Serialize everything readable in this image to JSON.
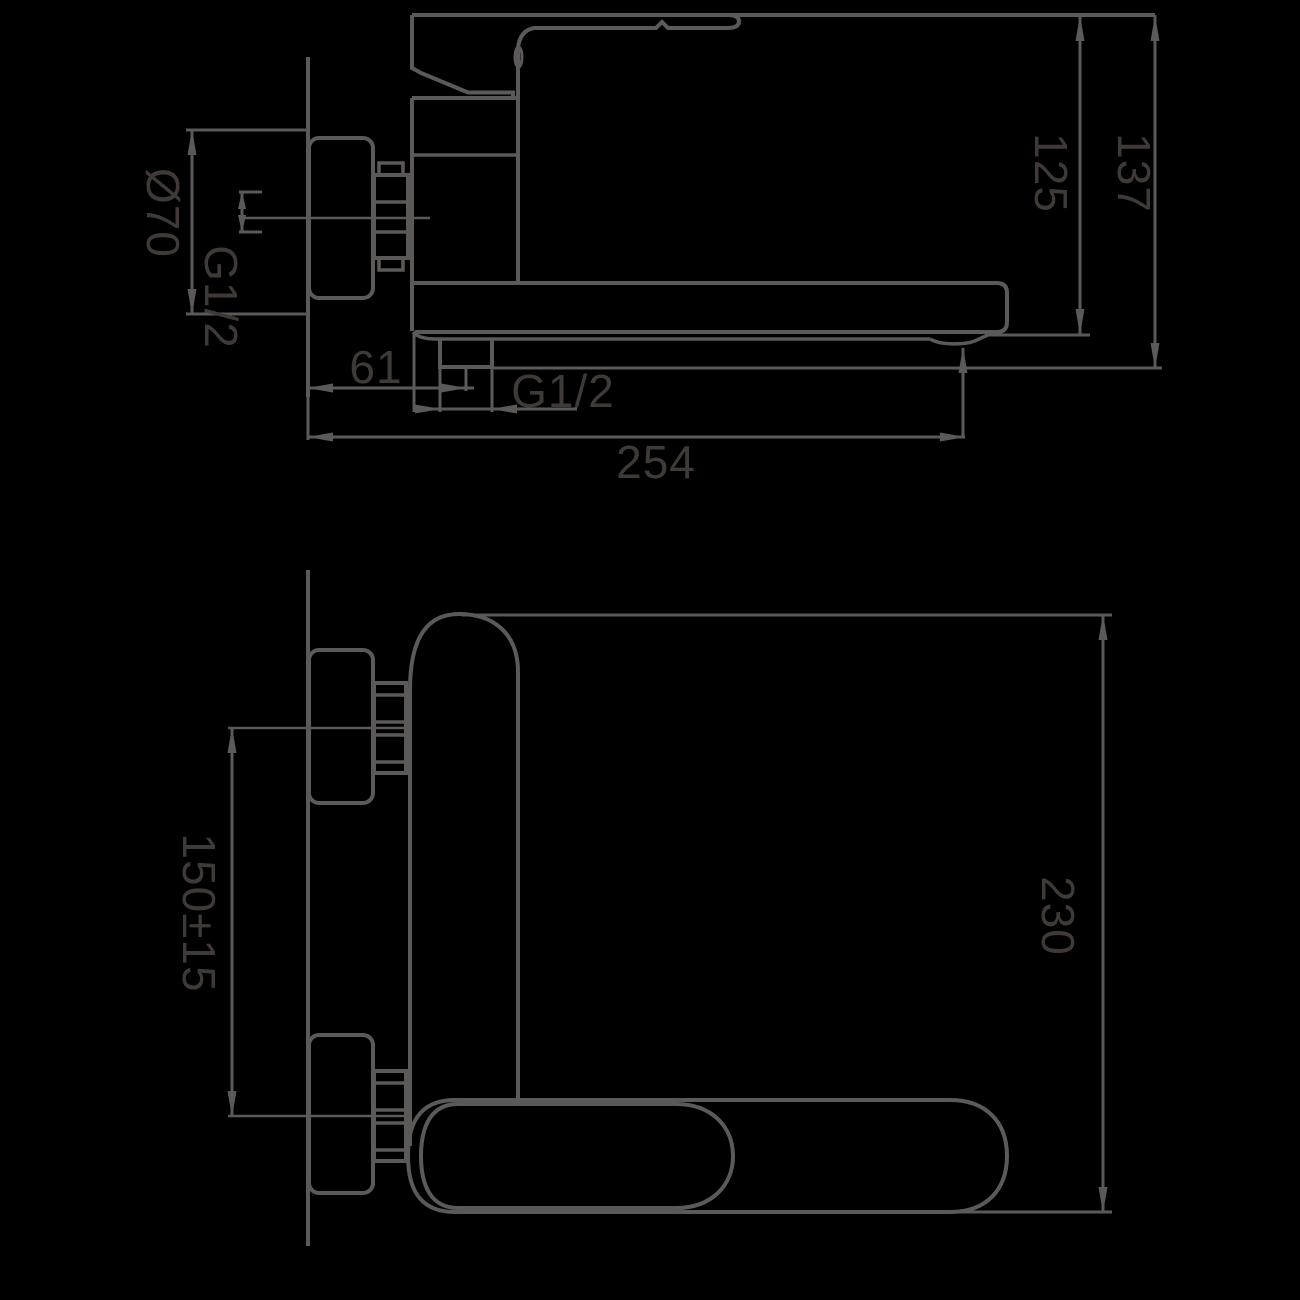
{
  "drawing": {
    "kind": "faucet-installation-technical-drawing",
    "views": {
      "side": {
        "dimensions": {
          "flange_diameter": "Ø70",
          "inlet_thread": "G1/2",
          "wall_to_outlet": "61",
          "outlet_thread": "G1/2",
          "overall_reach": "254",
          "height_to_spout": "125",
          "overall_height": "137"
        }
      },
      "plan": {
        "dimensions": {
          "inlet_spacing": "150±15",
          "spout_reach": "230"
        }
      }
    },
    "colors": {
      "background": "#000000",
      "line": "#5c5959",
      "label": "#3f3a37"
    }
  }
}
